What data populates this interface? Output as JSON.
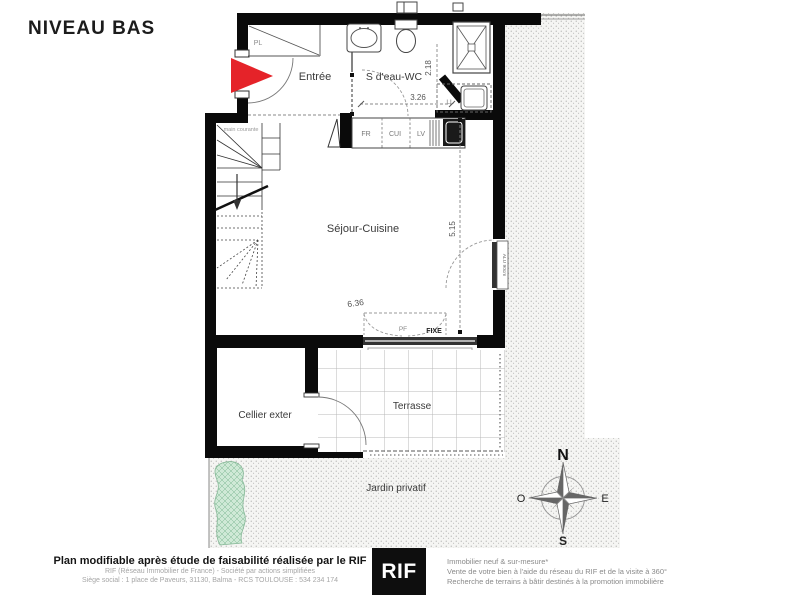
{
  "title": "NIVEAU BAS",
  "plan": {
    "labels": {
      "pl": "PL",
      "entree": "Entrée",
      "bain": "S d'eau-WC",
      "sejour": "Séjour-Cuisine",
      "cellier": "Cellier exter",
      "terrasse": "Terrasse",
      "jardin": "Jardin  privatif",
      "main_courante": "main courante",
      "fr": "FR",
      "cui": "CUI",
      "lv": "LV",
      "ll": "LL",
      "pf": "PF",
      "fixe": "FIXE",
      "alu": "ALU 90cm"
    },
    "dims": {
      "bath_width": "3.26",
      "bath_depth": "2.18",
      "sejour_height": "5.15",
      "sejour_width": "6.36"
    },
    "compass": {
      "n": "N",
      "s": "S",
      "e": "E",
      "o": "O"
    },
    "colors": {
      "wall": "#0a0a0a",
      "entry_arrow": "#e52329",
      "hedge_green": "#bfe3cb",
      "stipple_bg": "#f5f5f3"
    }
  },
  "footer": {
    "left": {
      "line1": "Plan modifiable après étude de faisabilité réalisée par le RIF",
      "line2": "RIF (Réseau Immobilier de France)  -  Société par actions simplifiées",
      "line3": "Siège social : 1 place de Paveurs, 31130,  Balma  -  RCS TOULOUSE : 534 234 174"
    },
    "logo": "RIF",
    "right": {
      "line1": "Immobilier neuf & sur-mesure*",
      "line2": "Vente de votre bien à l'aide du réseau du RIF et de la visite à 360°",
      "line3": "Recherche de terrains à bâtir destinés à la promotion immobilière"
    }
  }
}
